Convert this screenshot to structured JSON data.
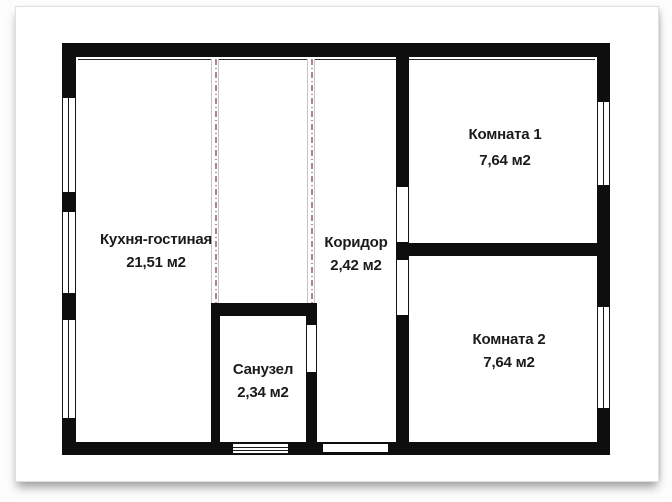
{
  "rooms": [
    {
      "name": "Кухня-гостиная",
      "area": "21,51 м2"
    },
    {
      "name": "Коридор",
      "area": "2,42 м2"
    },
    {
      "name": "Санузел",
      "area": "2,34 м2"
    },
    {
      "name": "Комната 1",
      "area": "7,64 м2"
    },
    {
      "name": "Комната 2",
      "area": "7,64 м2"
    }
  ],
  "colors": {
    "wall": "#0e0e0e",
    "partition_dash": "#b08585",
    "partition_edge": "#c4c4c4",
    "paper": "#ffffff"
  }
}
